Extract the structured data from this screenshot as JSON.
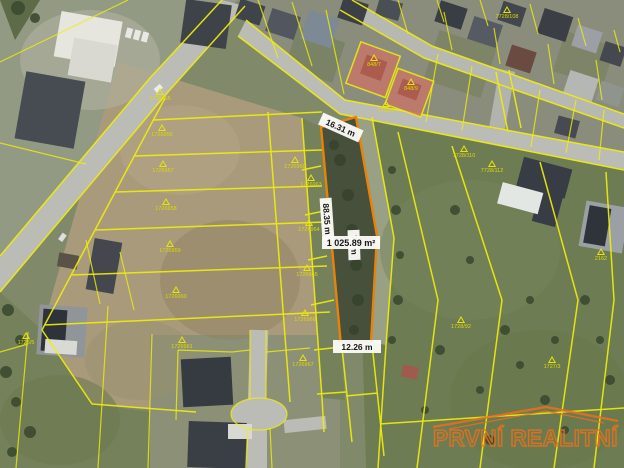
{
  "map": {
    "measurements": {
      "top_frontage": "16.31 m",
      "left_side": "88.35 m",
      "right_side": "71 m",
      "area": "1 025.89 m²",
      "bottom_frontage": "12.26 m"
    },
    "watermark_text": "PRVNÍ REALITNÍ",
    "colors": {
      "boundary_yellow": "#f0ed0a",
      "highlight_orange": "#e8820a",
      "watermark_orange": "#e8711c",
      "sold_parcel_fill": "#c4786a",
      "label_bg": "#fcfcf9",
      "label_text": "#161616"
    },
    "parcel_markers": [
      {
        "x": 160,
        "y": 100,
        "label": "1726955"
      },
      {
        "x": 162,
        "y": 136,
        "label": "1726956"
      },
      {
        "x": 163,
        "y": 172,
        "label": "1726957"
      },
      {
        "x": 166,
        "y": 210,
        "label": "1726958"
      },
      {
        "x": 170,
        "y": 252,
        "label": "1726959"
      },
      {
        "x": 176,
        "y": 298,
        "label": "1726960"
      },
      {
        "x": 182,
        "y": 348,
        "label": "1726961"
      },
      {
        "x": 311,
        "y": 186,
        "label": "1726963"
      },
      {
        "x": 309,
        "y": 231,
        "label": "1726964"
      },
      {
        "x": 307,
        "y": 276,
        "label": "1726965"
      },
      {
        "x": 305,
        "y": 321,
        "label": "1726966"
      },
      {
        "x": 303,
        "y": 366,
        "label": "1726967"
      },
      {
        "x": 295,
        "y": 168,
        "label": "1726969"
      },
      {
        "x": 507,
        "y": 18,
        "label": "7728/108"
      },
      {
        "x": 386,
        "y": 112,
        "label": "728/99"
      },
      {
        "x": 464,
        "y": 157,
        "label": "7728/110"
      },
      {
        "x": 492,
        "y": 172,
        "label": "7728/112"
      },
      {
        "x": 374,
        "y": 66,
        "label": "848/7"
      },
      {
        "x": 411,
        "y": 90,
        "label": "848/9"
      },
      {
        "x": 461,
        "y": 328,
        "label": "1728/92"
      },
      {
        "x": 26,
        "y": 344,
        "label": "1726/5"
      },
      {
        "x": 552,
        "y": 368,
        "label": "1727/3"
      },
      {
        "x": 601,
        "y": 260,
        "label": "2162"
      }
    ]
  }
}
